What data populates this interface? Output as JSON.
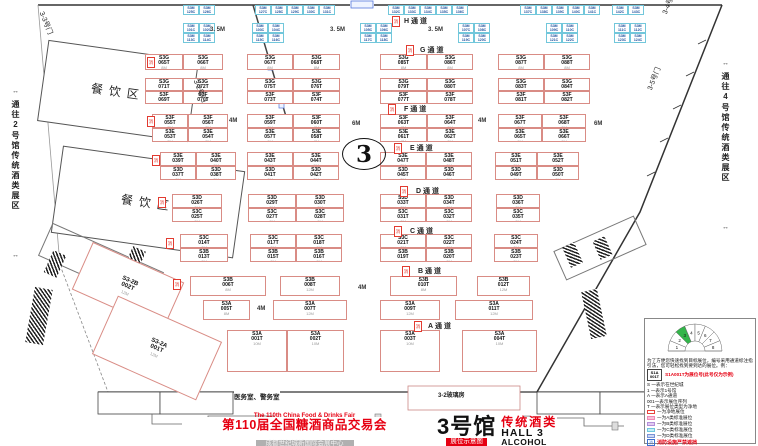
{
  "hall_circle": "3",
  "corridors": {
    "left": "通往2号馆传统酒类展区",
    "right": "通往4号馆传统酒类展区"
  },
  "rooms": {
    "dining": "餐饮区",
    "service": "医务室、警务室",
    "glass": "3-2玻璃房"
  },
  "doors": [
    {
      "label": "3-3号门",
      "x": 46,
      "y": 10,
      "rot": 68
    },
    {
      "label": "3-2号门",
      "x": 200,
      "y": 78,
      "rot": 68
    },
    {
      "label": "3-4号门",
      "x": 660,
      "y": 12,
      "rot": -68
    },
    {
      "label": "3-5号门",
      "x": 645,
      "y": 88,
      "rot": -68
    }
  ],
  "aisles": [
    {
      "label": "H通道",
      "x": 404,
      "y": 16
    },
    {
      "label": "G通道",
      "x": 420,
      "y": 45
    },
    {
      "label": "F通道",
      "x": 404,
      "y": 104
    },
    {
      "label": "E通道",
      "x": 410,
      "y": 143
    },
    {
      "label": "D通道",
      "x": 416,
      "y": 186
    },
    {
      "label": "C通道",
      "x": 410,
      "y": 226
    },
    {
      "label": "B通道",
      "x": 418,
      "y": 266
    },
    {
      "label": "A通道",
      "x": 428,
      "y": 321
    }
  ],
  "fire_tag": "消",
  "fires": [
    [
      392,
      16
    ],
    [
      406,
      45
    ],
    [
      388,
      104
    ],
    [
      394,
      143
    ],
    [
      400,
      186
    ],
    [
      394,
      226
    ],
    [
      402,
      266
    ],
    [
      414,
      321
    ],
    [
      147,
      57
    ],
    [
      147,
      116
    ],
    [
      152,
      155
    ],
    [
      158,
      197
    ],
    [
      166,
      238
    ],
    [
      173,
      279
    ]
  ],
  "dims": [
    {
      "t": "3. 5M",
      "x": 210,
      "y": 27
    },
    {
      "t": "3. 5M",
      "x": 330,
      "y": 27
    },
    {
      "t": "3. 5M",
      "x": 428,
      "y": 27
    },
    {
      "t": "4M",
      "x": 229,
      "y": 118
    },
    {
      "t": "4M",
      "x": 478,
      "y": 118
    },
    {
      "t": "6M",
      "x": 352,
      "y": 121
    },
    {
      "t": "6M",
      "x": 594,
      "y": 121
    },
    {
      "t": "4M",
      "x": 358,
      "y": 285
    },
    {
      "t": "4M",
      "x": 257,
      "y": 306
    }
  ],
  "booth_rows": [
    {
      "y": 54,
      "h": 16,
      "dim": "8M",
      "b": [
        [
          145,
          38,
          "S3G 065T"
        ],
        [
          183,
          40,
          "S3G 066T"
        ],
        [
          247,
          46,
          "S3G 067T"
        ],
        [
          293,
          47,
          "S3G 068T"
        ],
        [
          380,
          47,
          "S3G 085T"
        ],
        [
          427,
          46,
          "S3G 086T"
        ],
        [
          498,
          46,
          "S3G 087T"
        ],
        [
          544,
          46,
          "S3G 088T"
        ]
      ]
    },
    {
      "y": 78,
      "h": 13,
      "dim": "8M",
      "b": [
        [
          145,
          38,
          "S3G 071T"
        ],
        [
          183,
          40,
          "S3G 072T"
        ],
        [
          247,
          46,
          "S3G 075T"
        ],
        [
          293,
          47,
          "S3G 076T"
        ],
        [
          380,
          47,
          "S3G 079T"
        ],
        [
          427,
          46,
          "S3G 080T"
        ],
        [
          498,
          46,
          "S3G 083T"
        ],
        [
          544,
          46,
          "S3G 084T"
        ]
      ]
    },
    {
      "y": 91,
      "h": 13,
      "dim": "8M",
      "b": [
        [
          145,
          38,
          "S3F 069T"
        ],
        [
          183,
          40,
          "S3F 070T"
        ],
        [
          247,
          46,
          "S3F 073T"
        ],
        [
          293,
          47,
          "S3F 074T"
        ],
        [
          380,
          47,
          "S3F 077T"
        ],
        [
          427,
          46,
          "S3F 078T"
        ],
        [
          498,
          46,
          "S3F 081T"
        ],
        [
          544,
          46,
          "S3F 082T"
        ]
      ]
    },
    {
      "y": 114,
      "h": 14,
      "dim": "8M",
      "b": [
        [
          152,
          36,
          "S3F 055T",
          "7M"
        ],
        [
          188,
          40,
          "S3F 056T",
          "7M"
        ],
        [
          247,
          46,
          "S3F 059T"
        ],
        [
          293,
          47,
          "S3F 060T"
        ],
        [
          380,
          47,
          "S3F 063T"
        ],
        [
          427,
          46,
          "S3F 064T"
        ],
        [
          498,
          44,
          "S3F 067T"
        ],
        [
          542,
          44,
          "S3F 068T"
        ]
      ]
    },
    {
      "y": 128,
      "h": 14,
      "dim": "8M",
      "b": [
        [
          152,
          36,
          "S3E 053T",
          "7M"
        ],
        [
          188,
          40,
          "S3E 054T",
          "7M"
        ],
        [
          247,
          46,
          "S3E 057T"
        ],
        [
          293,
          47,
          "S3E 058T"
        ],
        [
          380,
          47,
          "S3E 061T"
        ],
        [
          427,
          46,
          "S3E 062T"
        ],
        [
          498,
          44,
          "S3E 065T"
        ],
        [
          542,
          44,
          "S3E 066T"
        ]
      ]
    },
    {
      "y": 152,
      "h": 14,
      "dim": "8M",
      "b": [
        [
          160,
          36,
          "S3E 039T"
        ],
        [
          196,
          40,
          "S3E 040T"
        ],
        [
          247,
          46,
          "S3E 043T"
        ],
        [
          293,
          46,
          "S3E 044T"
        ],
        [
          380,
          46,
          "S3E 047T"
        ],
        [
          426,
          46,
          "S3E 048T"
        ],
        [
          495,
          42,
          "S3E 051T"
        ],
        [
          537,
          42,
          "S3E 052T"
        ]
      ]
    },
    {
      "y": 166,
      "h": 14,
      "dim": "8M",
      "b": [
        [
          160,
          36,
          "S3D 037T"
        ],
        [
          196,
          40,
          "S3D 038T"
        ],
        [
          247,
          46,
          "S3D 041T"
        ],
        [
          293,
          46,
          "S3D 042T"
        ],
        [
          380,
          46,
          "S3D 045T"
        ],
        [
          426,
          46,
          "S3D 046T"
        ],
        [
          495,
          42,
          "S3D 049T"
        ],
        [
          537,
          42,
          "S3D 050T"
        ]
      ]
    },
    {
      "y": 194,
      "h": 14,
      "dim": "8M",
      "b": [
        [
          172,
          50,
          "S3D 026T"
        ],
        [
          248,
          48,
          "S3D 029T"
        ],
        [
          296,
          48,
          "S3D 030T"
        ],
        [
          380,
          46,
          "S3D 033T"
        ],
        [
          426,
          46,
          "S3D 034T"
        ],
        [
          496,
          44,
          "S3D 036T"
        ]
      ]
    },
    {
      "y": 208,
      "h": 14,
      "dim": "8M",
      "b": [
        [
          172,
          50,
          "S3C 025T"
        ],
        [
          248,
          48,
          "S3C 027T"
        ],
        [
          296,
          48,
          "S3C 028T"
        ],
        [
          380,
          46,
          "S3C 031T"
        ],
        [
          426,
          46,
          "S3C 032T"
        ],
        [
          496,
          44,
          "S3C 035T"
        ]
      ]
    },
    {
      "y": 234,
      "h": 14,
      "dim": "8M",
      "b": [
        [
          180,
          48,
          "S3C 014T"
        ],
        [
          250,
          46,
          "S3C 017T"
        ],
        [
          296,
          46,
          "S3C 018T"
        ],
        [
          380,
          46,
          "S3C 021T"
        ],
        [
          426,
          46,
          "S3C 022T"
        ],
        [
          494,
          44,
          "S3C 024T"
        ]
      ]
    },
    {
      "y": 248,
      "h": 14,
      "dim": "8M",
      "b": [
        [
          180,
          48,
          "S3B 013T"
        ],
        [
          250,
          46,
          "S3B 015T"
        ],
        [
          296,
          46,
          "S3B 016T"
        ],
        [
          380,
          46,
          "S3B 019T"
        ],
        [
          426,
          46,
          "S3B 020T"
        ],
        [
          494,
          44,
          "S3B 023T"
        ]
      ]
    },
    {
      "y": 276,
      "h": 20,
      "dim": "",
      "b": [
        [
          190,
          76,
          "S3B 006T",
          "8M"
        ],
        [
          280,
          60,
          "S3B 008T",
          "12M"
        ],
        [
          390,
          67,
          "S3B 010T",
          "8M"
        ],
        [
          477,
          53,
          "S3B 012T",
          "12M"
        ]
      ]
    },
    {
      "y": 300,
      "h": 20,
      "dim": "",
      "b": [
        [
          203,
          47,
          "S3A 005T",
          "8M"
        ],
        [
          273,
          74,
          "S3A 007T",
          "12M"
        ],
        [
          380,
          60,
          "S3A 009T",
          "12M"
        ],
        [
          455,
          78,
          "S3A 011T",
          "12M"
        ]
      ]
    },
    {
      "y": 330,
      "h": 42,
      "dim": "",
      "b": [
        [
          227,
          60,
          "S3A 001T",
          "10M"
        ],
        [
          287,
          57,
          "S3A 002T",
          "10M"
        ],
        [
          380,
          60,
          "S3A 003T",
          "10M"
        ],
        [
          462,
          75,
          "S3A 004T",
          "10M"
        ]
      ]
    }
  ],
  "small_booth_w": 16,
  "small_rows": [
    {
      "y": 5,
      "h": 10,
      "groups": [
        {
          "x": 183,
          "ids": [
            "S3M 125C",
            "S3M 126C"
          ]
        },
        {
          "x": 255,
          "ids": [
            "S3M 127C",
            "S3M 128C",
            "S3M 129C",
            "S3M 130C",
            "S3M 131C"
          ]
        },
        {
          "x": 388,
          "ids": [
            "S3M 132C",
            "S3M 133C",
            "S3M 134C",
            "S3M 135C",
            "S3M 136C"
          ]
        },
        {
          "x": 520,
          "ids": [
            "S3M 137C",
            "S3M 138C",
            "S3M 139C",
            "S3M 140C",
            "S3M 141C"
          ]
        },
        {
          "x": 612,
          "ids": [
            "S3M 142C",
            "S3M 143C"
          ]
        }
      ]
    },
    {
      "y": 23,
      "h": 10,
      "groups": [
        {
          "x": 183,
          "ids": [
            "S3M 101C",
            "S3M 102C"
          ]
        },
        {
          "x": 252,
          "ids": [
            "S3M 103C",
            "S3M 104C"
          ]
        },
        {
          "x": 360,
          "ids": [
            "S3M 105C",
            "S3M 106C"
          ]
        },
        {
          "x": 458,
          "ids": [
            "S3M 107C",
            "S3M 108C"
          ]
        },
        {
          "x": 546,
          "ids": [
            "S3M 109C",
            "S3M 110C"
          ]
        },
        {
          "x": 614,
          "ids": [
            "S3M 111C",
            "S3M 112C"
          ]
        }
      ]
    },
    {
      "y": 33,
      "h": 10,
      "groups": [
        {
          "x": 183,
          "ids": [
            "S3M 113C",
            "S3M 114C"
          ]
        },
        {
          "x": 252,
          "ids": [
            "S3M 115C",
            "S3M 116C"
          ]
        },
        {
          "x": 360,
          "ids": [
            "S3M 117C",
            "S3M 118C"
          ]
        },
        {
          "x": 458,
          "ids": [
            "S3M 119C",
            "S3M 120C"
          ]
        },
        {
          "x": 546,
          "ids": [
            "S3M 121C",
            "S3M 122C"
          ]
        },
        {
          "x": 614,
          "ids": [
            "S3M 123C",
            "S3M 124C"
          ]
        }
      ]
    }
  ],
  "rot_booths": [
    {
      "x": 78,
      "y": 260,
      "w": 98,
      "h": 50,
      "rot": 24,
      "id": "S3-2B 002T",
      "dim": "12M"
    },
    {
      "x": 100,
      "y": 316,
      "w": 112,
      "h": 62,
      "rot": 24,
      "id": "S3-2A 001T",
      "dim": "12M"
    }
  ],
  "legend": {
    "intro": "为了方便您快速找到目标展位，编号采用通道标注指引法，您可轻松找到要到达的展位。例：",
    "example_line1": "S1A",
    "example_line2": "001T",
    "example_note": "S1A001T为展位号(此号仅为示例)",
    "rules": [
      "S 一表示在世纪城",
      "1 一表示1号馆",
      "A 一表示A通道",
      "001一表示展位序列",
      "T 一表示展位类型为净地"
    ],
    "classes": [
      {
        "label": "一为净地展位",
        "fill": "#ffffff",
        "border": "#e8433c"
      },
      {
        "label": "一为A类标准展位",
        "fill": "#f9c2d9",
        "border": "#ef8ab5"
      },
      {
        "label": "一为B类标准展位",
        "fill": "#e0cbf0",
        "border": "#b490da"
      },
      {
        "label": "一为C类标准展位",
        "fill": "#c6edf6",
        "border": "#6fc8dd"
      },
      {
        "label": "一为D类标准展位",
        "fill": "#cdd8f4",
        "border": "#7a93d6"
      }
    ],
    "fire_icon": "消",
    "fire_note": "消防设施严禁遮挡",
    "fan_numbers": [
      "1",
      "2",
      "3",
      "4",
      "5",
      "6",
      "7",
      "8"
    ],
    "fan_highlight_index": 2,
    "fan_color": "#33b54a"
  },
  "title_bar": {
    "fair_en": "The 110th China Food & Drinks Fair",
    "fair_cn": "第110届全国糖酒商品交易会",
    "venue": "成都世纪城新国际会展中心",
    "hall_cn": "3号馆",
    "map_label": "展位示意图",
    "category_cn": "传统酒类",
    "hall_en": "HALL 3",
    "category_en": "ALCOHOL"
  }
}
